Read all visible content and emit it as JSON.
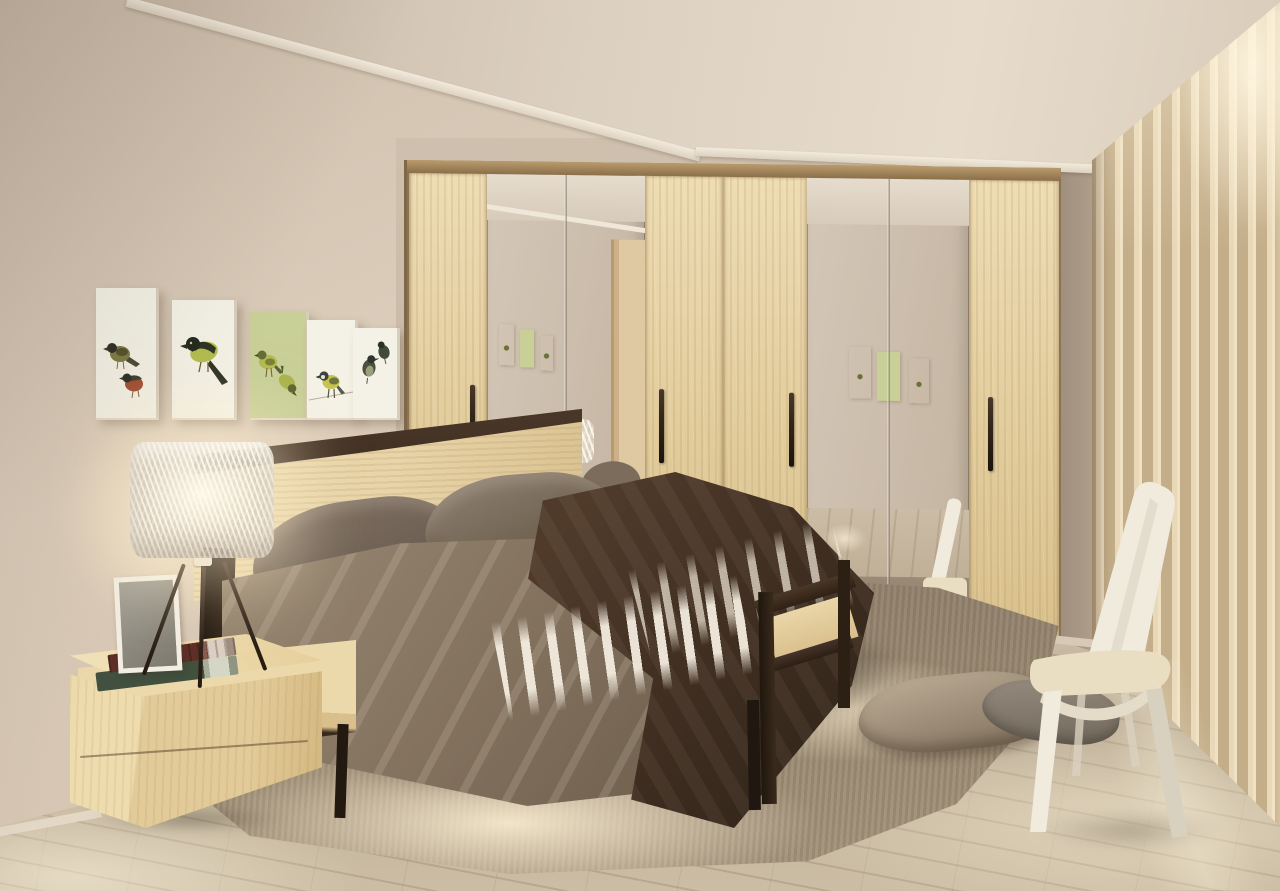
{
  "scene": {
    "type": "interior-photograph",
    "room": "bedroom",
    "style": "3D visualization of a modern bedroom with light sonoma oak and dark wenge furniture",
    "lighting": "warm table-lamp glow on the left wall, soft daylight through sheer curtains on the right",
    "objects": {
      "walls": {
        "label": "Warm beige painted walls"
      },
      "ceiling": {
        "label": "Beige ceiling with white cornice moulding"
      },
      "floor": {
        "label": "Light grey-beige wooden plank floor"
      },
      "gallery": {
        "label": "Row of five small bird paintings on the left wall",
        "count": 5
      },
      "wardrobe": {
        "label": "Eight-panel light oak wardrobe with four mirrored doors and dark vertical handles",
        "wood_doors": 4,
        "mirror_doors": 4,
        "handles": 4
      },
      "reflection": {
        "label": "Mirror doors reflecting the room: bird paintings, lamp, bed, rug, cushions, chair and a door"
      },
      "bed": {
        "label": "Double bed with oak and wenge frame, taupe bedding, dark brown throw and white sheet fringe",
        "pillows": 2
      },
      "headboard": {
        "label": "Light oak headboard panel with wenge top rail"
      },
      "nightstand": {
        "label": "Light oak two-drawer nightstand",
        "drawers": 2
      },
      "lamp": {
        "label": "Table lamp with woven white drum shade on dark tripod legs"
      },
      "frame": {
        "label": "White photo frame standing on the nightstand"
      },
      "books": {
        "label": "Two hardcover books stacked on the nightstand",
        "count": 2
      },
      "rug": {
        "label": "Shaggy taupe rug with sunlit cream patches under the bed"
      },
      "floor_pillows": {
        "label": "Two taupe floor cushions on the rug",
        "count": 2
      },
      "chair": {
        "label": "Cream high-back chair standing by the window"
      },
      "curtains": {
        "label": "Floor-length beige sheer curtains on the right wall"
      }
    }
  },
  "palette": {
    "wallLeft": "#d7c8b6",
    "wallBack": "#cfc0ae",
    "wallRight": "#ab9a88",
    "ceilA": "#c6b6a4",
    "ceilB": "#e7dccc",
    "cornice": "#f2eadc",
    "oak": "#e8d4a8",
    "oakDeep": "#d9c190",
    "wenge": "#3e2d20",
    "mirror": "#d4c7b7",
    "mirrorDark": "#c3b3a0",
    "floorA": "#cdbfa8",
    "floorB": "#b7a88f",
    "plank": "rgba(115,96,74,0.2)",
    "rugBase": "#97876f",
    "rugLit": "#f1e4c6",
    "underShadow": "rgba(32,23,14,0.55)",
    "duvetA": "#94846f",
    "duvetB": "#6f5f4e",
    "blanketA": "#503b2b",
    "blanketB": "#32251a",
    "pillowBrA": "#7d6f62",
    "pillowBrB": "#5f5245",
    "sheet": "#f1e9da",
    "curtA": "#e9d8b8",
    "curtB": "#c4ae8a",
    "chair": "#f1ebdd",
    "chairShade": "#d9d1bf",
    "cushion": "#e9ddc2",
    "glow": "rgba(255,239,203,0.5)",
    "handle": "#31261a",
    "metal": "#2a211a",
    "bookRed": "#5f2f27",
    "bookGreen": "#41503f",
    "pages": "#d4d6c6",
    "frame": "#f3eee3",
    "photo": "#7e7a6f",
    "canvas": "#f4f2e6",
    "canvasGreen": "#c8cf97",
    "birdDark": "#2f3528",
    "birdGreen": "#b3bd4f",
    "birdOlive": "#7d7c44",
    "birdRed": "#a04a30",
    "birdYellow": "#c6c34e"
  }
}
